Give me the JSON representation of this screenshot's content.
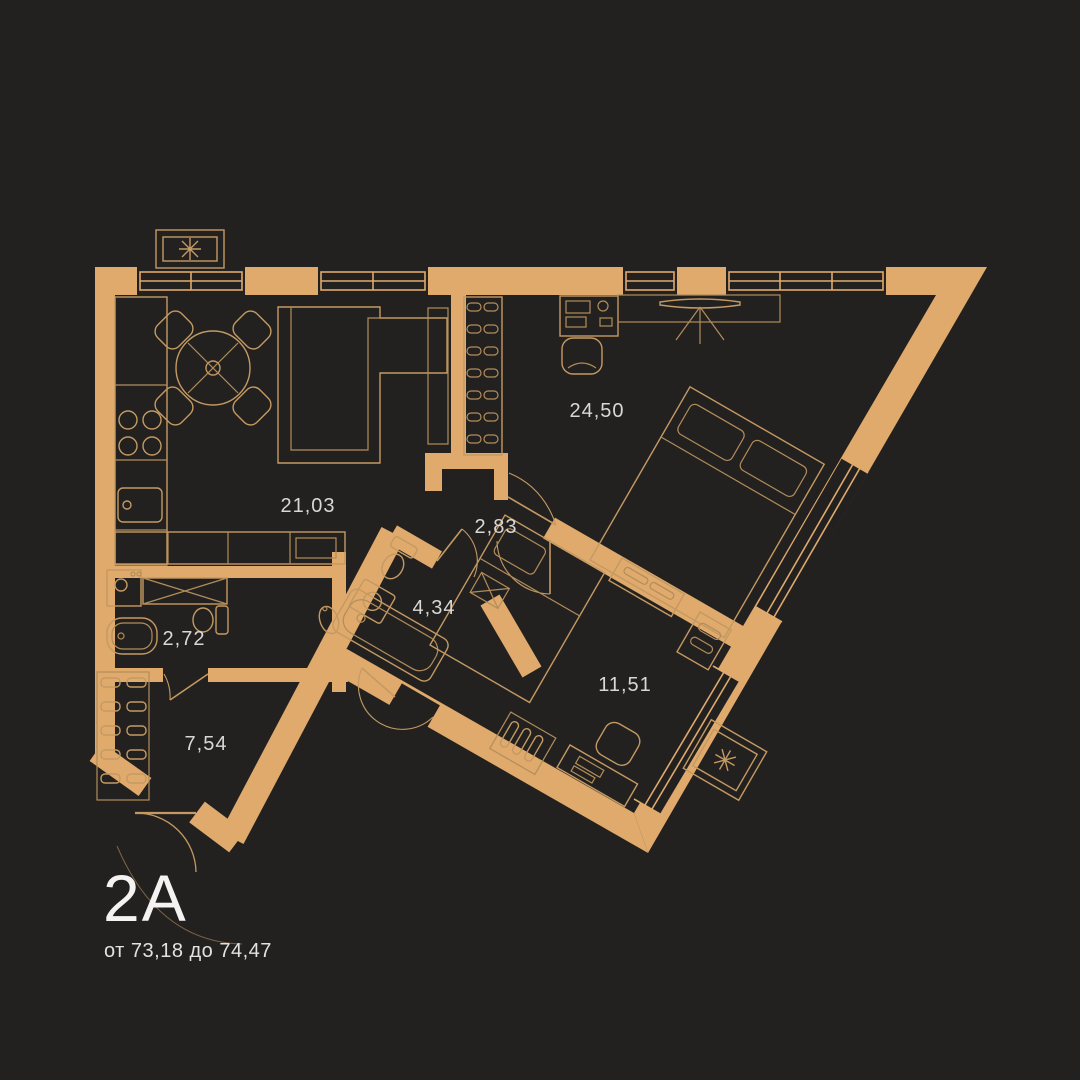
{
  "palette": {
    "background": "#232120",
    "wall_accent": "#dfaa6c",
    "furniture_line": "#c49a62",
    "label_color": "#d9d8d6",
    "title_color": "#f4f3f1"
  },
  "plan": {
    "code": "2А",
    "area_range": "от 73,18 до 74,47"
  },
  "rooms": [
    {
      "name": "kitchen-living",
      "area": "21,03"
    },
    {
      "name": "bedroom-main",
      "area": "24,50"
    },
    {
      "name": "hall-inner",
      "area": "2,83"
    },
    {
      "name": "bathroom",
      "area": "4,34"
    },
    {
      "name": "wc",
      "area": "2,72"
    },
    {
      "name": "entry-hall",
      "area": "7,54"
    },
    {
      "name": "bedroom-second",
      "area": "11,51"
    }
  ],
  "icons": {
    "ac_units": [
      {
        "name": "ac-asterisk-top"
      },
      {
        "name": "ac-asterisk-bottom"
      }
    ]
  }
}
